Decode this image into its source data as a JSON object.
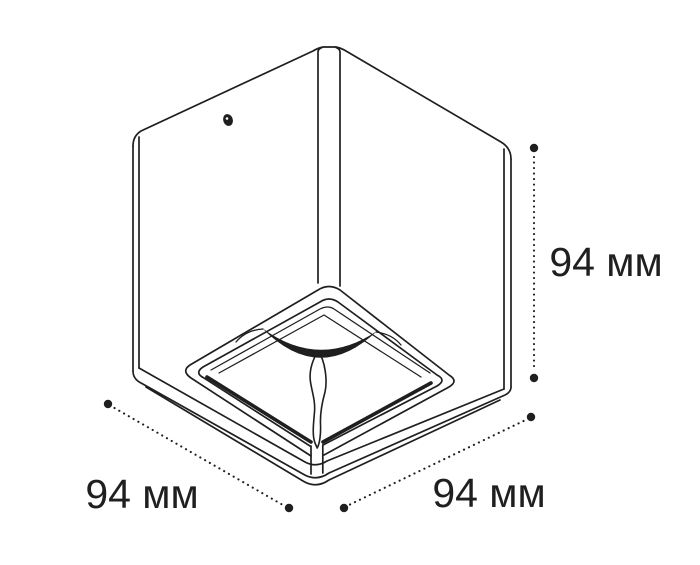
{
  "drawing": {
    "labels": {
      "height": "94 мм",
      "width": "94 мм",
      "depth": "94 мм"
    }
  },
  "colors": {
    "line": "#1f1f1f",
    "background": "#ffffff"
  }
}
